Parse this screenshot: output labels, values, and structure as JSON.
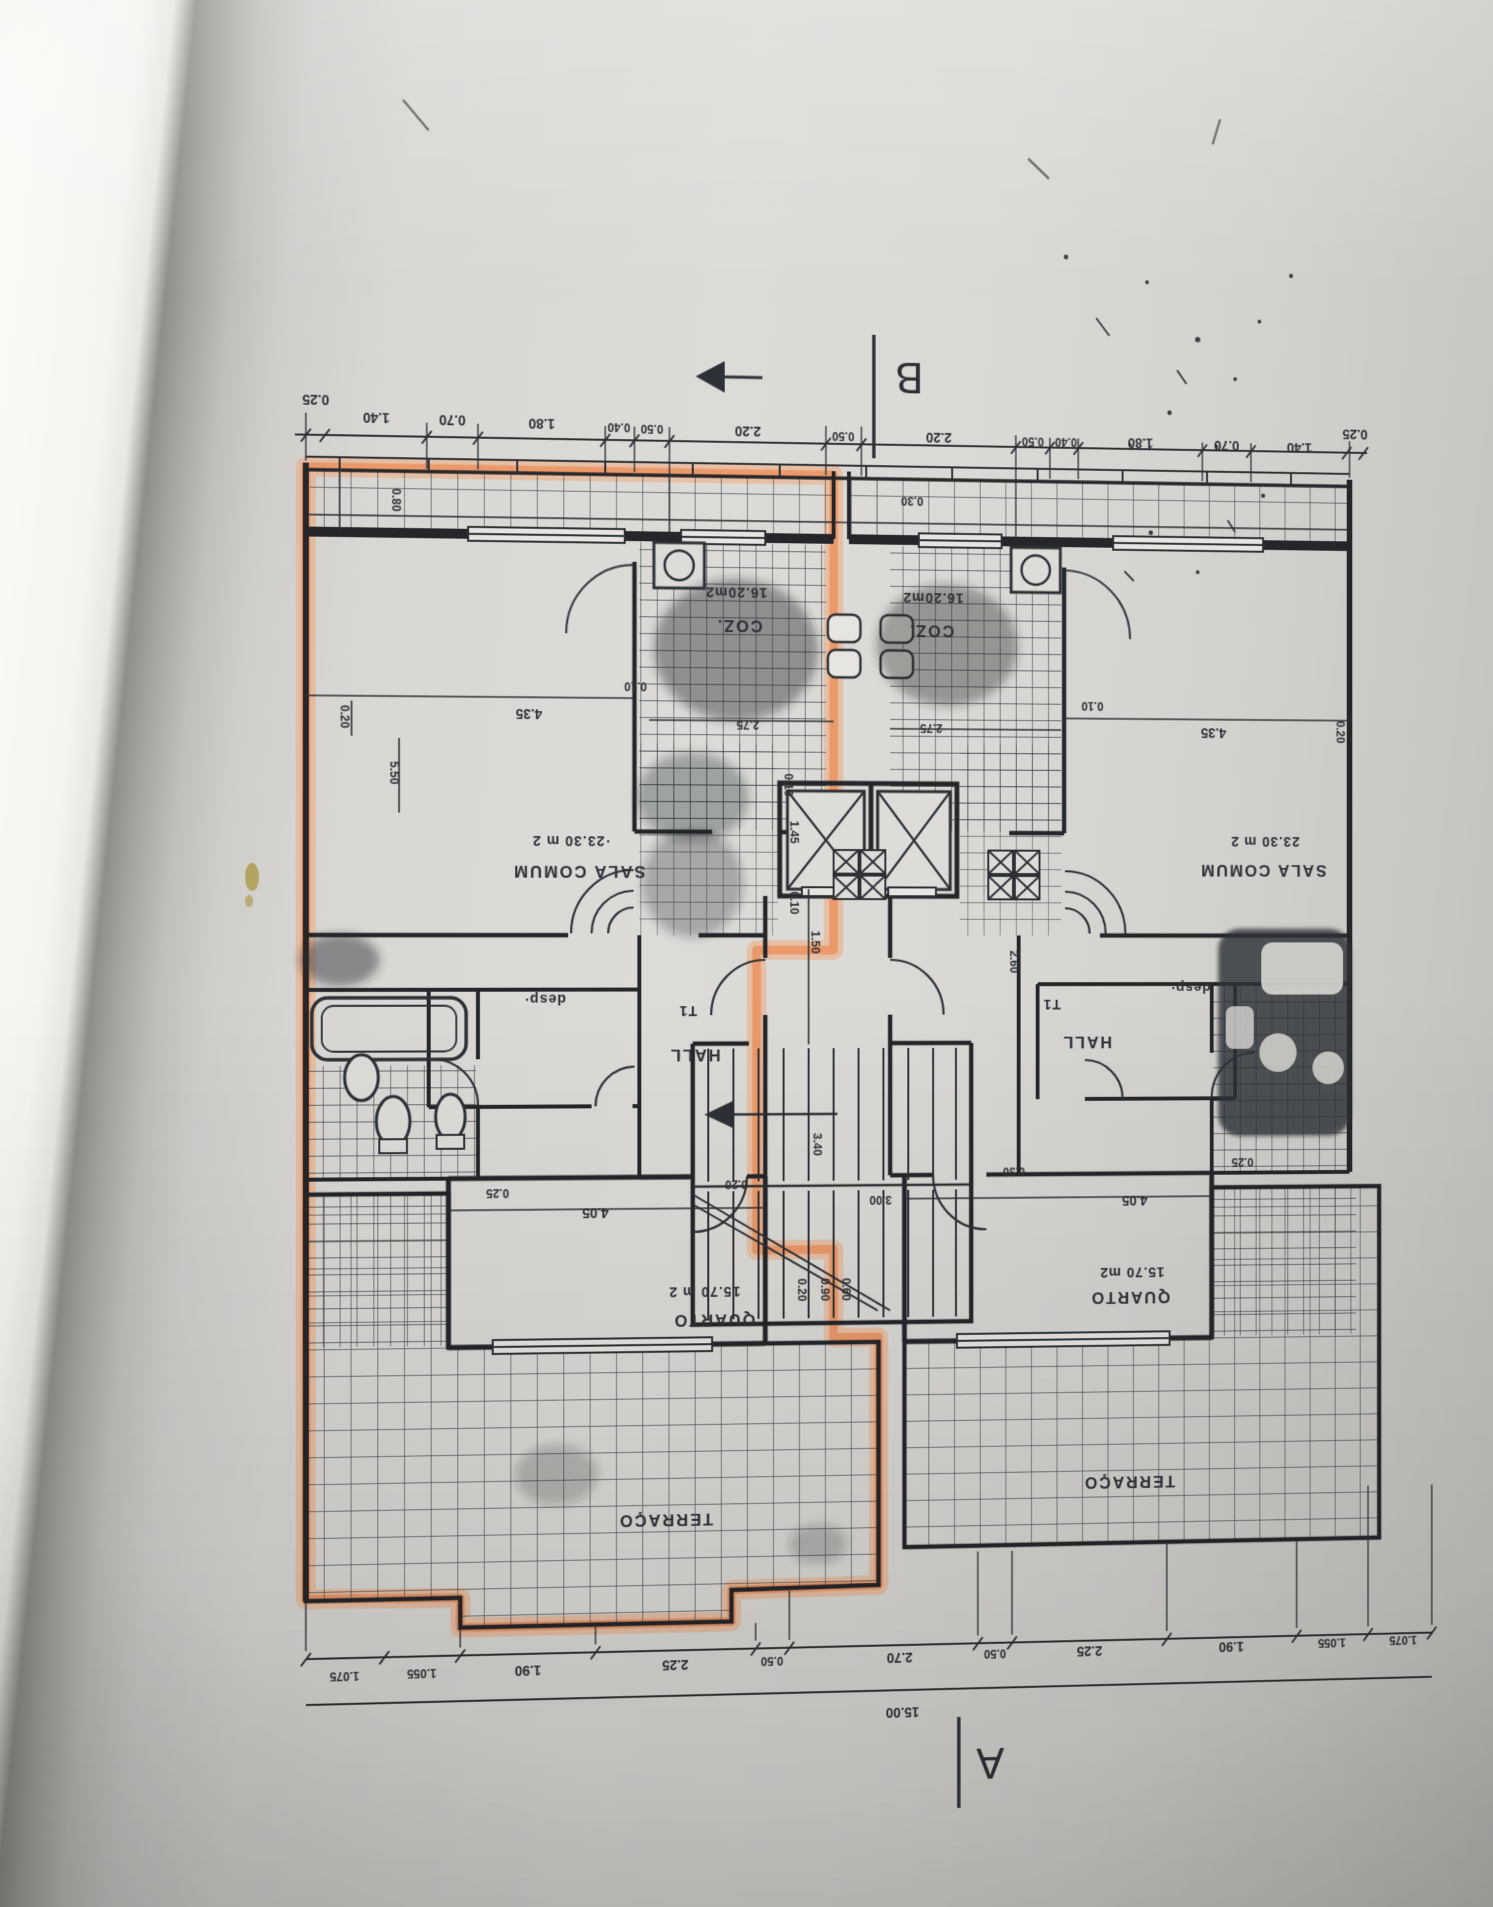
{
  "colors": {
    "paper": "#d8d7d3",
    "paper_edge_white": "#f8f8f5",
    "binding_shadow": "#8f8e8a",
    "ink": "#2d3035",
    "highlight_orange": "#f2915c",
    "stain_olive": "#ad9b4e"
  },
  "section_markers": {
    "a": "A",
    "b": "B"
  },
  "rooms": {
    "sala_left": {
      "name": "SALA COMUM",
      "area": "·23.30 m 2"
    },
    "sala_right": {
      "name": "SALA COMUM",
      "area": "23.30 m 2"
    },
    "coz_left": {
      "name": "COZ.",
      "area": "16.20m2"
    },
    "coz_right": {
      "name": "COZ.",
      "area": "16.20m2"
    },
    "quarto_left": {
      "name": "QUARTO",
      "area": "15.70 m 2"
    },
    "quarto_right": {
      "name": "QUARTO",
      "area": "15.70 m2"
    },
    "hall_left": {
      "name": "HALL",
      "unit": "T1"
    },
    "hall_right": {
      "name": "HALL",
      "unit": "T1"
    },
    "desp_left": {
      "name": "desp·"
    },
    "desp_right": {
      "name": "desp·"
    },
    "terraco_left": {
      "name": "TERRAÇO"
    },
    "terraco_right": {
      "name": "TERRAÇO"
    }
  },
  "dims": {
    "top": [
      "0.25",
      "1.40",
      "0.70",
      "1.80",
      "0.40",
      "0.50",
      "2.20",
      "0.50",
      "2.20",
      "0.50",
      "0.40",
      "1.80",
      "0.70",
      "1.40",
      "0.25"
    ],
    "bottom": [
      "1.075",
      "1.055",
      "1.90",
      "2.25",
      "0.50",
      "2.70",
      "0.50",
      "2.25",
      "1.90",
      "1.055",
      "1.075"
    ],
    "total_width": "15.00",
    "side": {
      "balcony_depth": "0.80",
      "left_wall": "0.20",
      "sala_left_height": "5.50",
      "right_wall": "0.20",
      "balcony_center": "0.30"
    },
    "inner": {
      "sala_left_width": "4.35",
      "sala_left_gap": "0.10",
      "coz_left_width": "2.75",
      "coz_right_width": "2.75",
      "sala_right_gap": "0.10",
      "sala_right_width": "4.35",
      "elev_depth": "1.45",
      "elev_wall": "0.10",
      "lobby_wall": "0.10",
      "lobby_width": "1.50",
      "entry_right": "2.60",
      "hall_left_wall": "0.20",
      "quarto_left_sill": "0.25",
      "quarto_left_width": "4.05",
      "quarto_left_wall": "0.20",
      "stair_width": "3.00",
      "stair_run": "3.40",
      "stair_wall": "0.30",
      "quarto_right_width": "4.05",
      "quarto_right_sill": "0.25",
      "stair_a": "0.20",
      "stair_b": "0.90",
      "stair_c": "0.60"
    }
  }
}
